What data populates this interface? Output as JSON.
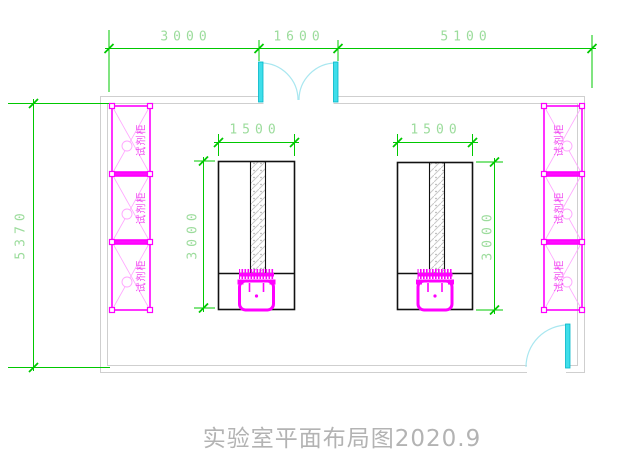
{
  "title": "实验室平面布局图2020.9",
  "dimensions": {
    "top": {
      "left_span": "3000",
      "door_span": "1600",
      "right_span": "5100"
    },
    "left_wall_height": "5370",
    "bench_width": "1500",
    "bench_depth": "3000"
  },
  "cabinets": {
    "label": "试剂柜",
    "left_count": 3,
    "right_count": 3
  },
  "colors": {
    "dimension_line": "#00c800",
    "dimension_text": "#9cdc9c",
    "cabinet_magenta": "#ff00ff",
    "cabinet_brace": "#ffa6ff",
    "door_leaf_cyan": "#3fdeea",
    "door_arc": "#a9e7f0",
    "wall_gray": "#cfcfcf",
    "bench_outline": "#111111",
    "title_gray": "#b3b3b3"
  }
}
